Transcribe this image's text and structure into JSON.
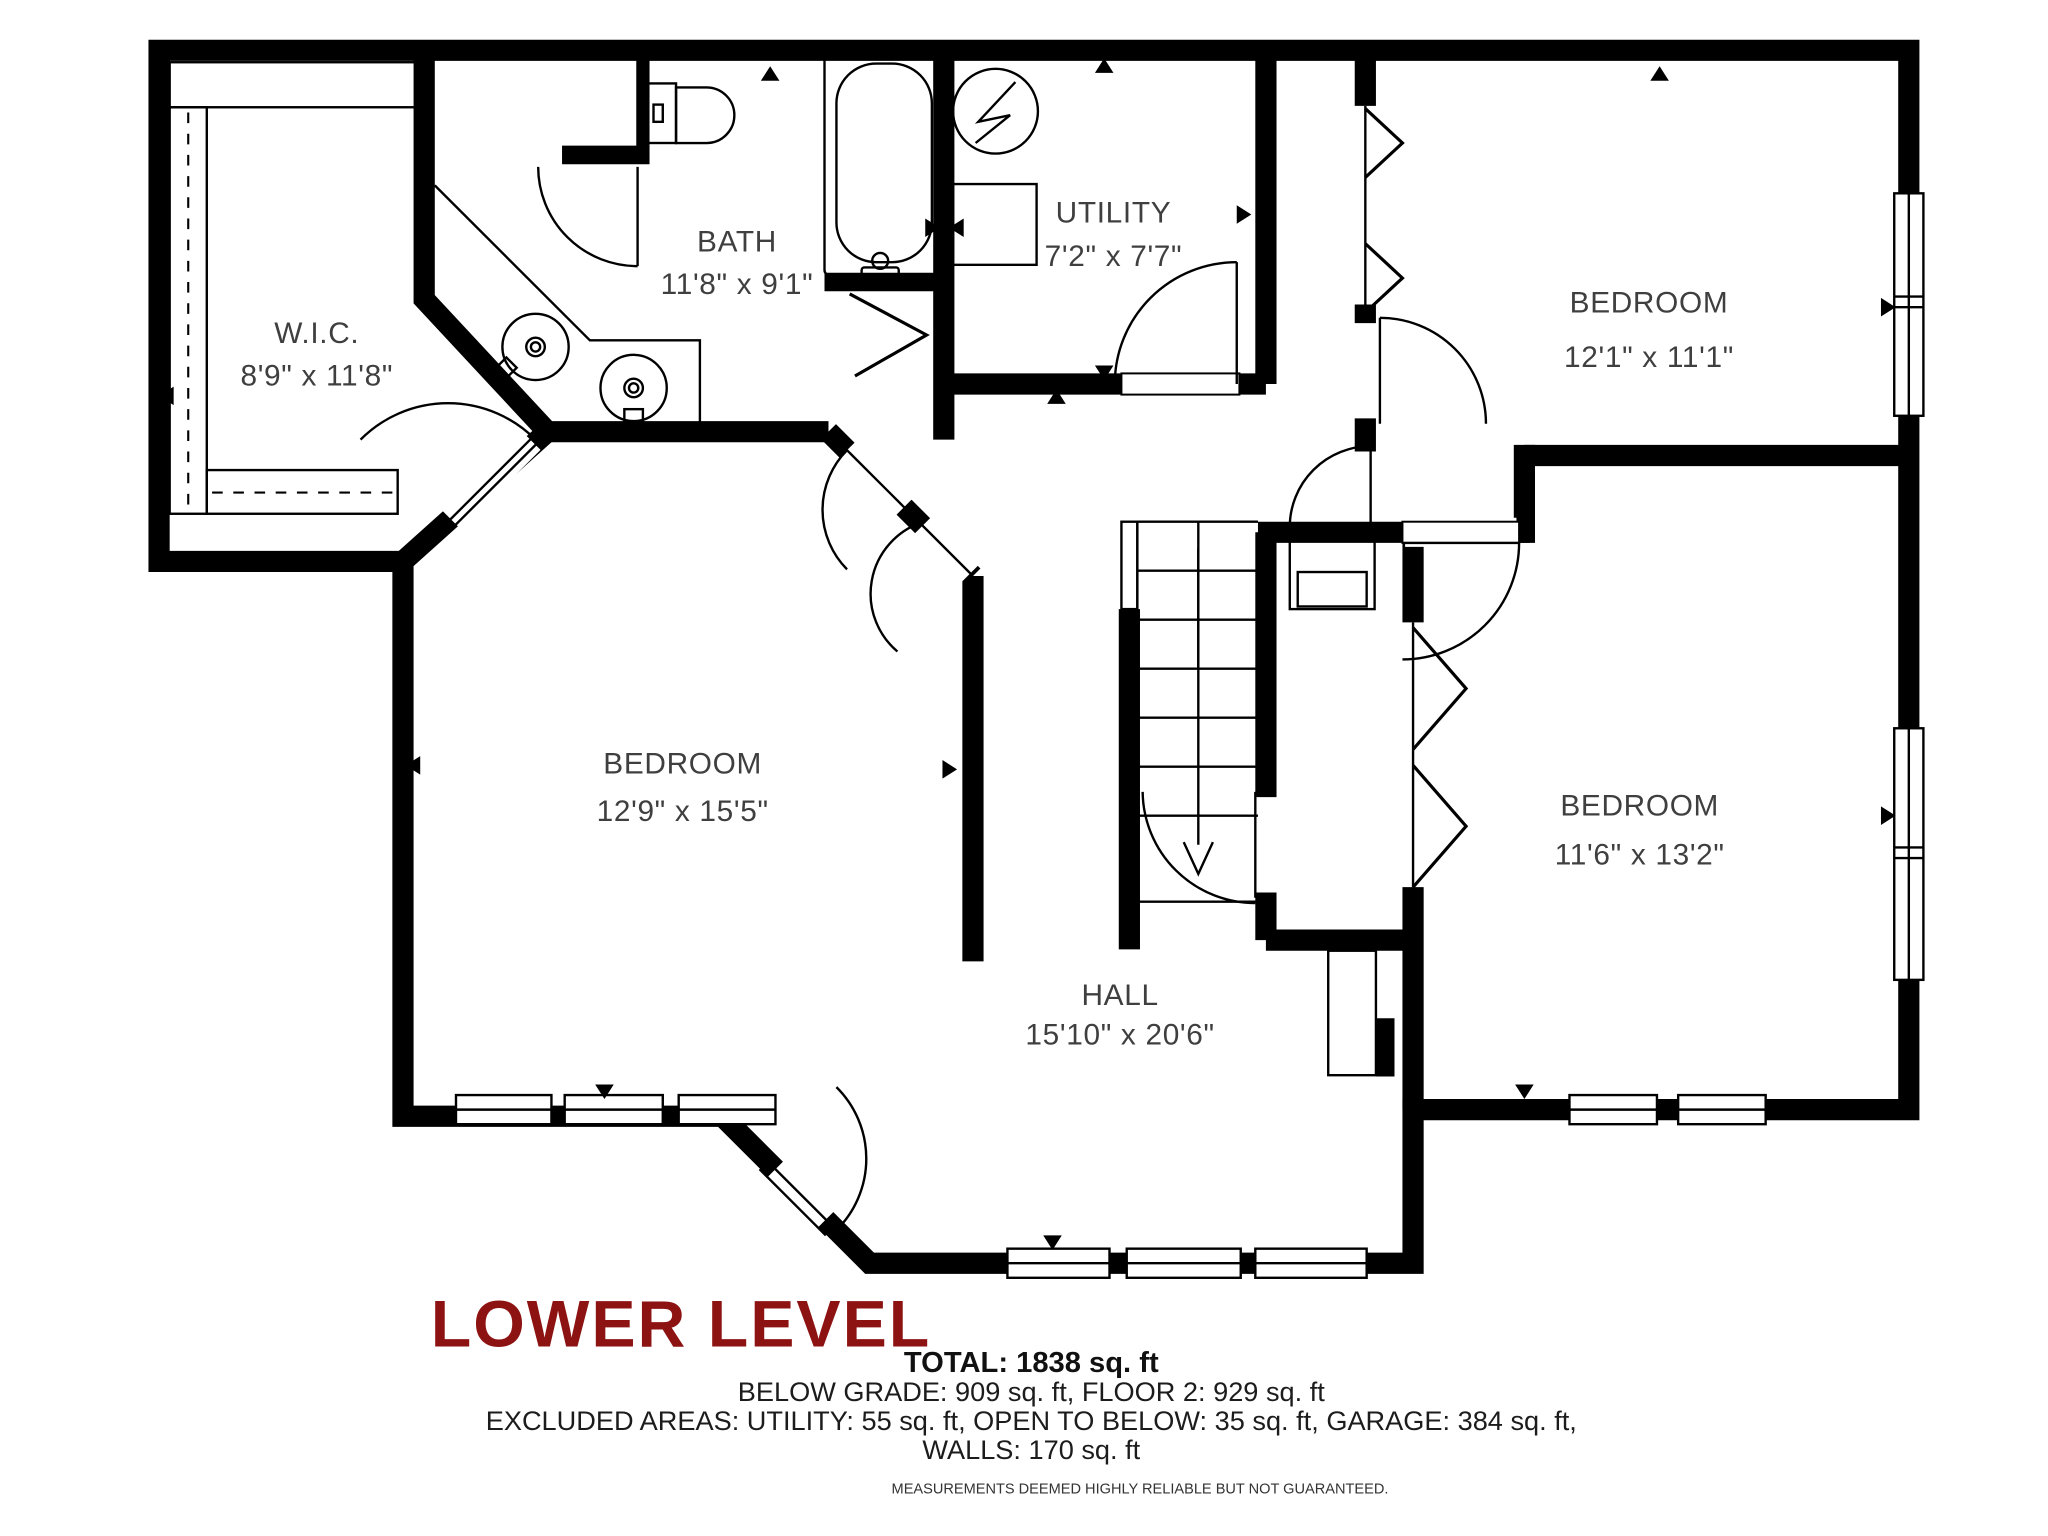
{
  "title": {
    "text": "LOWER LEVEL",
    "color": "#8D1212"
  },
  "rooms": [
    {
      "name": "W.I.C.",
      "dims": "8'9\" x 11'8\""
    },
    {
      "name": "BATH",
      "dims": "11'8\" x 9'1\""
    },
    {
      "name": "UTILITY",
      "dims": "7'2\" x 7'7\""
    },
    {
      "name": "BEDROOM",
      "dims": "12'1\" x 11'1\""
    },
    {
      "name": "BEDROOM",
      "dims": "12'9\" x 15'5\""
    },
    {
      "name": "BEDROOM",
      "dims": "11'6\" x 13'2\""
    },
    {
      "name": "HALL",
      "dims": "15'10\" x 20'6\""
    }
  ],
  "summary": {
    "total": "TOTAL: 1838 sq. ft",
    "grade_line": "BELOW GRADE: 909 sq. ft, FLOOR 2: 929 sq. ft",
    "excluded_line": "EXCLUDED AREAS: UTILITY: 55 sq. ft, OPEN TO BELOW: 35 sq. ft, GARAGE: 384 sq. ft,",
    "walls_line": "WALLS: 170 sq. ft"
  },
  "disclaimer": "MEASUREMENTS DEEMED HIGHLY RELIABLE BUT NOT GUARANTEED.",
  "colors": {
    "walls": "#000000",
    "labels": "#3F3F3F"
  }
}
